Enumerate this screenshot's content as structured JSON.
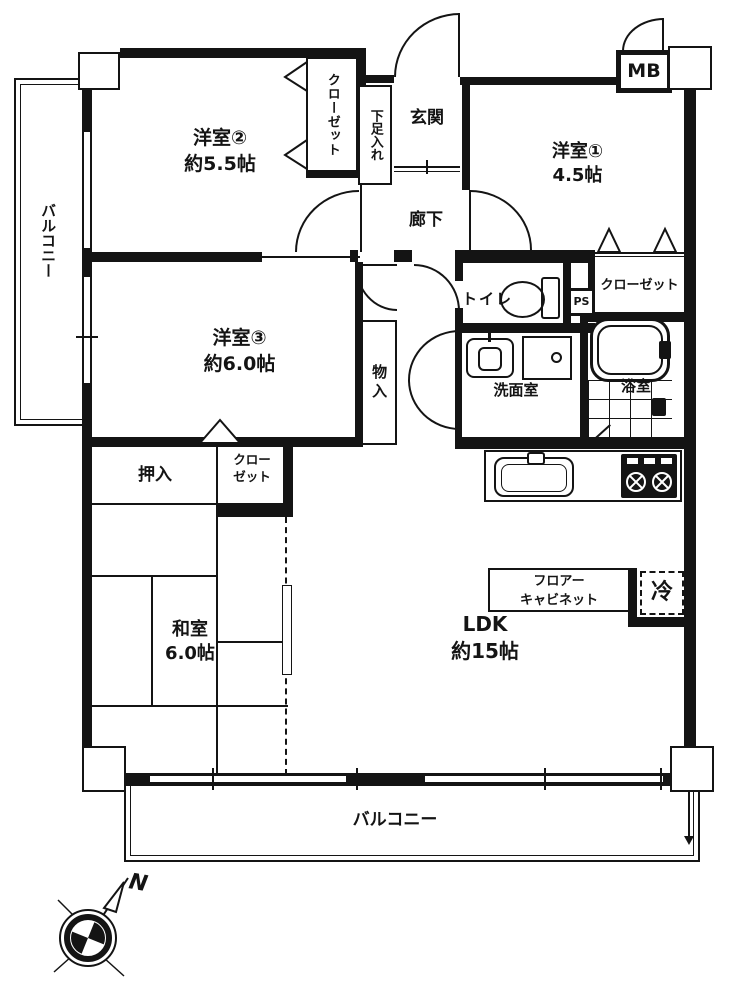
{
  "floorplan": {
    "rooms": {
      "western2": {
        "name": "洋室②",
        "size": "約5.5帖"
      },
      "western1": {
        "name": "洋室①",
        "size": "4.5帖"
      },
      "western3": {
        "name": "洋室③",
        "size": "約6.0帖"
      },
      "japanese": {
        "name": "和室",
        "size": "6.0帖"
      },
      "ldk": {
        "name": "LDK",
        "size": "約15帖"
      },
      "entrance": {
        "name": "玄関"
      },
      "hallway": {
        "name": "廊下"
      },
      "toilet": {
        "name": "トイレ"
      },
      "washroom": {
        "name": "洗面室"
      },
      "bathroom": {
        "name": "浴室"
      }
    },
    "storage": {
      "closet_w2": "クローゼット",
      "closet_w1": "クローゼット",
      "closet_washitsu_line1": "クロー",
      "closet_washitsu_line2": "ゼット",
      "shoe_cabinet": "下足入れ",
      "storage_in": "物入",
      "oshiire": "押入"
    },
    "fixtures": {
      "meter_box": "MB",
      "pipe_shaft": "PS",
      "refrigerator": "冷",
      "floor_cabinet_line1": "フロアー",
      "floor_cabinet_line2": "キャビネット"
    },
    "balcony_left": "バルコニー",
    "balcony_bottom": "バルコニー",
    "compass_north": "N",
    "colors": {
      "wall": "#141414",
      "background": "#ffffff"
    }
  }
}
